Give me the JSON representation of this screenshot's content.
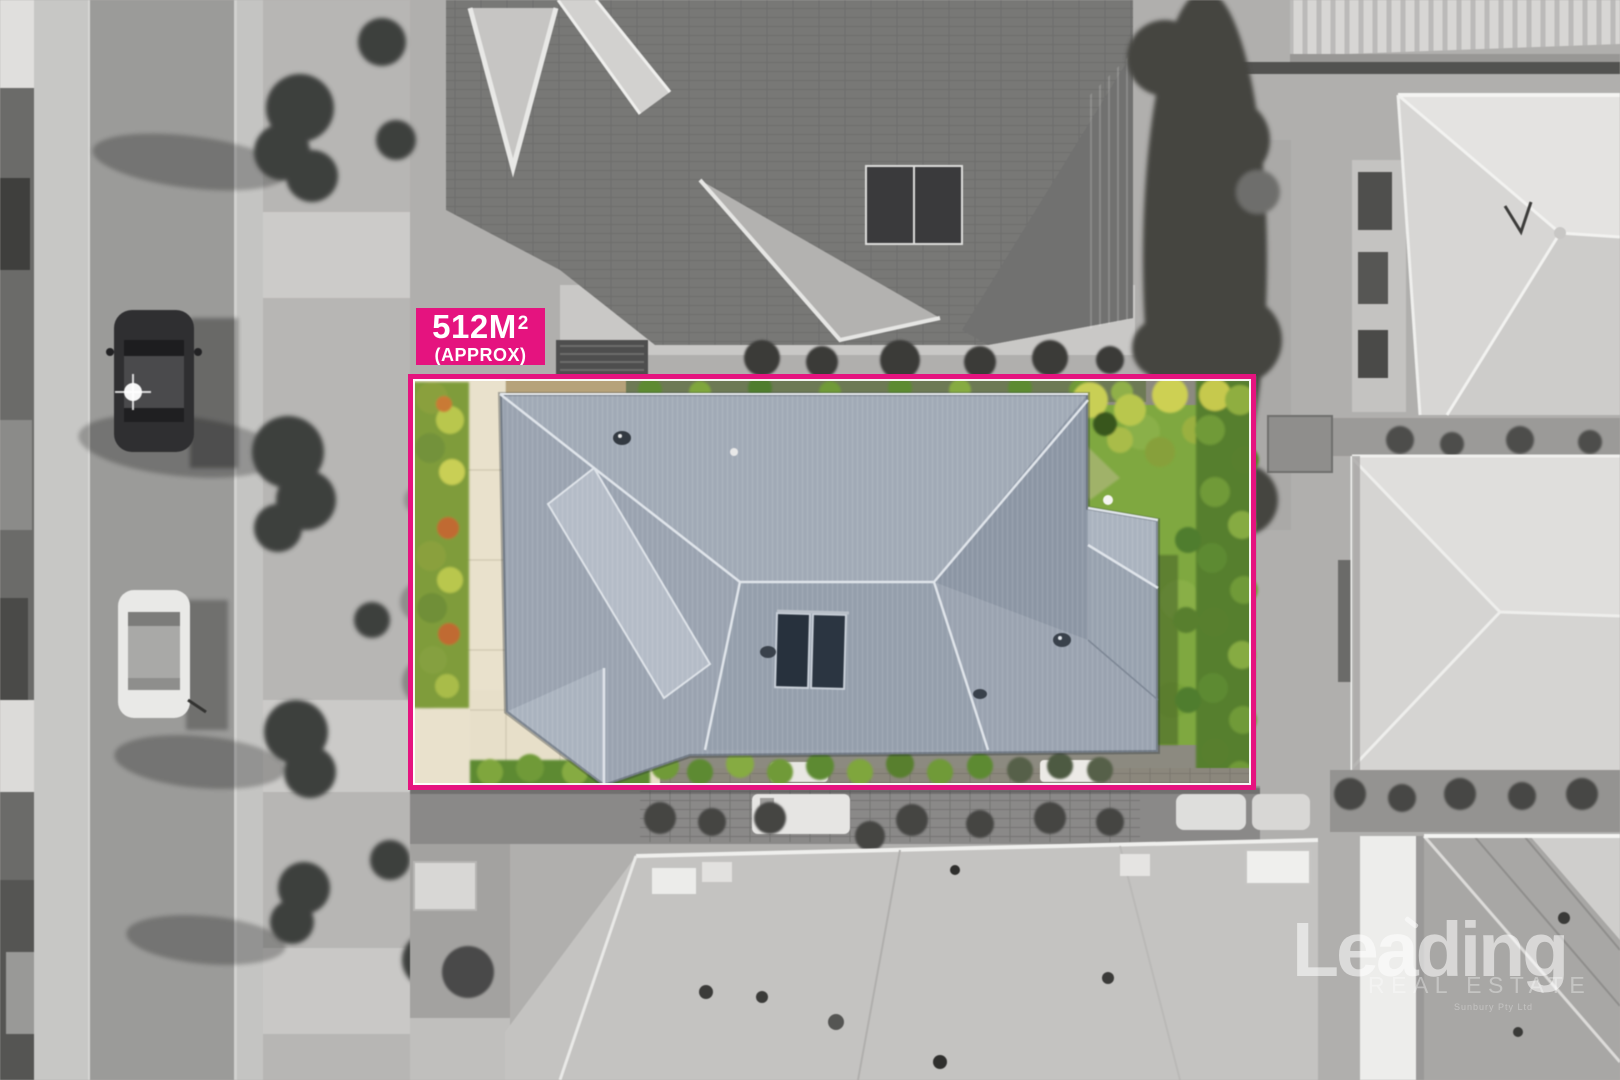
{
  "image": {
    "kind": "aerial-drone-photo",
    "subject": "single-storey home with grey corrugated hip roof highlighted in colour inside a greyscale suburban streetscape"
  },
  "area_label": {
    "value": "512M",
    "superscript": "2",
    "qualifier": "(APPROX)"
  },
  "watermark": {
    "brand": "Leading",
    "tagline": "REAL ESTATE",
    "subtext": "Sunbury Pty Ltd"
  },
  "colors": {
    "accent_pink": "#E5137F",
    "boundary_inner_line": "#FFFFFF",
    "property_roof_grey": "#9AA3B0",
    "lawn_green": "#7FA840",
    "hedge_green": "#5D8A33",
    "driveway_cream": "#E9E1CC"
  }
}
